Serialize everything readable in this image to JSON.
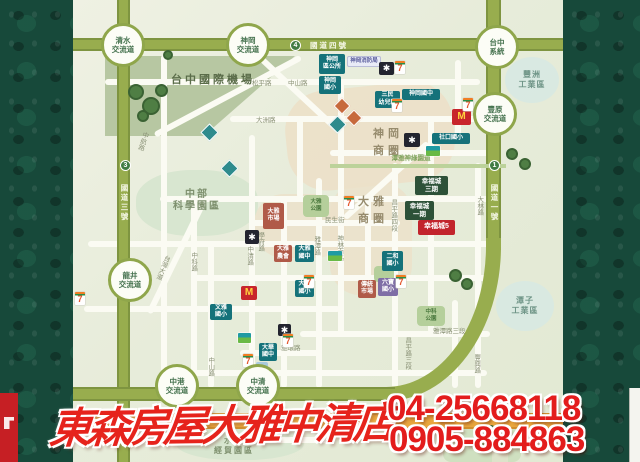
{
  "banner": {
    "store_name": "東森房屋大雅中清店",
    "phone_1": "04-25668118",
    "phone_2": "0905-884863"
  },
  "colors": {
    "accent_red": "#e3231d",
    "highway_olive": "#98ad4e",
    "orange_road": "#e8a63e",
    "school_teal": "#15727a",
    "project_green": "#2d5138",
    "featured_red": "#c2242c",
    "border_green": "#17493a"
  },
  "map": {
    "items": [
      {
        "n": "airport-zone",
        "c": "patch-sage",
        "x": 105,
        "y": 56,
        "w": 190,
        "h": 80
      },
      {
        "n": "science-park-zone",
        "c": "patch-mint",
        "x": 136,
        "y": 170,
        "w": 122,
        "h": 66
      },
      {
        "n": "shengang-commercial-zone",
        "c": "patch-beige",
        "x": 286,
        "y": 86,
        "w": 168,
        "h": 100,
        "rot": -6
      },
      {
        "n": "daya-commercial-zone",
        "c": "patch-beige2",
        "x": 330,
        "y": 183,
        "w": 82,
        "h": 112
      },
      {
        "n": "daya-commercial-zone",
        "c": "patch-beige2",
        "x": 254,
        "y": 194,
        "w": 92,
        "h": 64
      },
      {
        "n": "shuinan-zone",
        "c": "patch-mint",
        "x": 176,
        "y": 424,
        "w": 128,
        "h": 36
      },
      {
        "n": "stadium-zone",
        "c": "patch-green",
        "x": 443,
        "y": 418,
        "w": 78,
        "h": 44
      },
      {
        "n": "tree",
        "c": "tree",
        "x": 128,
        "y": 84,
        "w": 16,
        "h": 16
      },
      {
        "n": "tree",
        "c": "tree",
        "x": 142,
        "y": 97,
        "w": 18,
        "h": 18
      },
      {
        "n": "tree",
        "c": "tree",
        "x": 155,
        "y": 84,
        "w": 13,
        "h": 13
      },
      {
        "n": "tree",
        "c": "tree",
        "x": 137,
        "y": 110,
        "w": 12,
        "h": 12
      },
      {
        "n": "tree",
        "c": "tree",
        "x": 163,
        "y": 50,
        "w": 10,
        "h": 10
      },
      {
        "n": "tree",
        "c": "tree",
        "x": 231,
        "y": 51,
        "w": 10,
        "h": 10
      },
      {
        "n": "tree",
        "c": "tree",
        "x": 506,
        "y": 148,
        "w": 12,
        "h": 12
      },
      {
        "n": "tree",
        "c": "tree",
        "x": 519,
        "y": 158,
        "w": 12,
        "h": 12
      },
      {
        "n": "tree",
        "c": "tree",
        "x": 449,
        "y": 269,
        "w": 13,
        "h": 13
      },
      {
        "n": "tree",
        "c": "tree",
        "x": 461,
        "y": 278,
        "w": 12,
        "h": 12
      },
      {
        "n": "tree",
        "c": "tree",
        "x": 484,
        "y": 425,
        "w": 13,
        "h": 13
      },
      {
        "n": "tree",
        "c": "tree",
        "x": 497,
        "y": 436,
        "w": 12,
        "h": 12
      },
      {
        "n": "interchange-qingshui",
        "c": "ic",
        "x": 101,
        "y": 23,
        "t": "清水\n交流道"
      },
      {
        "n": "interchange-shengang",
        "c": "ic",
        "x": 226,
        "y": 23,
        "t": "神岡\n交流道"
      },
      {
        "n": "interchange-taichung-system",
        "c": "ic",
        "x": 475,
        "y": 25,
        "t": "台中\n系統"
      },
      {
        "n": "interchange-fengyuan",
        "c": "ic",
        "x": 473,
        "y": 92,
        "t": "豐原\n交流道"
      },
      {
        "n": "interchange-longjing",
        "c": "ic",
        "x": 108,
        "y": 258,
        "t": "龍井\n交流道"
      },
      {
        "n": "interchange-zhonggang",
        "c": "ic",
        "x": 155,
        "y": 364,
        "t": "中港\n交流道"
      },
      {
        "n": "interchange-zhongqing",
        "c": "ic",
        "x": 236,
        "y": 364,
        "t": "中清\n交流道"
      },
      {
        "n": "freeway4-shield",
        "c": "shield",
        "x": 290,
        "y": 40,
        "t": "4"
      },
      {
        "n": "freeway3-shield",
        "c": "shield",
        "x": 120,
        "y": 160,
        "t": "3"
      },
      {
        "n": "freeway1-shield",
        "c": "shield",
        "x": 489,
        "y": 160,
        "t": "1"
      },
      {
        "n": "freeway4-label",
        "c": "hlab",
        "x": 304,
        "y": 41,
        "w": 50,
        "t": "國道四號"
      },
      {
        "n": "freeway3-label",
        "c": "hlab-v",
        "x": 119,
        "y": 174,
        "w": 11,
        "h": 58,
        "t": "國道三號"
      },
      {
        "n": "freeway1-label",
        "c": "hlab-v",
        "x": 489,
        "y": 174,
        "w": 11,
        "h": 58,
        "t": "國道一號"
      },
      {
        "n": "area-label-airport",
        "c": "area-dark",
        "x": 157,
        "y": 74,
        "w": 112,
        "t": "台中國際機場"
      },
      {
        "n": "area-label-science-park",
        "c": "area",
        "x": 154,
        "y": 189,
        "w": 86,
        "t": "中部\n科學園區"
      },
      {
        "n": "area-label-shengang-shops",
        "c": "area-tan",
        "x": 360,
        "y": 126,
        "w": 56,
        "t": "神岡\n商圈"
      },
      {
        "n": "area-label-daya-shops",
        "c": "area-tan",
        "x": 346,
        "y": 194,
        "w": 54,
        "t": "大雅\n商圈"
      },
      {
        "n": "area-label-shuinan",
        "c": "area",
        "x": 192,
        "y": 436,
        "w": 84,
        "t": "水楠\n經貿園區",
        "fs": 8
      },
      {
        "n": "zone-fengzhou-industrial",
        "c": "zone",
        "x": 505,
        "y": 57,
        "w": 54,
        "h": 46,
        "t": "豐洲\n工業區"
      },
      {
        "n": "zone-tanzi-industrial",
        "c": "zone",
        "x": 496,
        "y": 281,
        "w": 58,
        "h": 50,
        "t": "潭子\n工業區"
      },
      {
        "n": "label-ballfield",
        "c": "green-lab",
        "x": 466,
        "y": 441,
        "w": 30,
        "t": "球場"
      },
      {
        "n": "label-bikeway",
        "c": "green-lab",
        "x": 378,
        "y": 155,
        "w": 66,
        "t": "潭雅神綠園道"
      },
      {
        "n": "road-label-songping",
        "c": "rlab",
        "x": 252,
        "y": 80,
        "t": "松平路"
      },
      {
        "n": "road-label-zhongshan-n",
        "c": "rlab",
        "x": 288,
        "y": 80,
        "t": "中山路"
      },
      {
        "n": "road-label-dazhou",
        "c": "rlab",
        "x": 256,
        "y": 117,
        "t": "大洲路"
      },
      {
        "n": "road-label-taiwan-blvd",
        "c": "rlab-v",
        "x": 158,
        "y": 246,
        "h": 42,
        "t": "台灣大道",
        "rot": 22
      },
      {
        "n": "road-label-zhongke",
        "c": "rlab-v",
        "x": 189,
        "y": 246,
        "h": 32,
        "t": "中科路"
      },
      {
        "n": "road-label-zhongshan-s",
        "c": "rlab-v",
        "x": 206,
        "y": 352,
        "h": 30,
        "t": "中山路"
      },
      {
        "n": "road-label-zhongqing",
        "c": "rlab-v",
        "x": 245,
        "y": 240,
        "h": 32,
        "t": "中清路"
      },
      {
        "n": "road-label-xuefu",
        "c": "rlab-v",
        "x": 256,
        "y": 227,
        "h": 30,
        "t": "學府路"
      },
      {
        "n": "road-label-yatan",
        "c": "rlab-v",
        "x": 312,
        "y": 230,
        "h": 32,
        "t": "雅潭路"
      },
      {
        "n": "road-label-shenlin-s",
        "c": "rlab-v",
        "x": 335,
        "y": 228,
        "h": 40,
        "t": "神林南路"
      },
      {
        "n": "road-label-changping-4",
        "c": "rlab-v",
        "x": 389,
        "y": 192,
        "h": 46,
        "t": "昌平路四段"
      },
      {
        "n": "road-label-changping-3",
        "c": "rlab-v",
        "x": 403,
        "y": 330,
        "h": 46,
        "t": "昌平路三段"
      },
      {
        "n": "road-label-yahuan",
        "c": "rlab",
        "x": 281,
        "y": 345,
        "t": "雅環路"
      },
      {
        "n": "road-label-yatan-3",
        "c": "rlab",
        "x": 433,
        "y": 328,
        "t": "雅潭路三段"
      },
      {
        "n": "road-label-dalin",
        "c": "rlab-v",
        "x": 475,
        "y": 190,
        "h": 32,
        "t": "大林路"
      },
      {
        "n": "road-label-fengxing",
        "c": "rlab-v",
        "x": 472,
        "y": 348,
        "h": 32,
        "t": "豐興路"
      },
      {
        "n": "road-label-minsheng",
        "c": "rlab",
        "x": 325,
        "y": 217,
        "t": "民生街"
      },
      {
        "n": "road-label-zhonghang",
        "c": "rlab-v",
        "x": 138,
        "y": 126,
        "h": 30,
        "t": "中航路",
        "rot": 18
      },
      {
        "n": "road-label-route10",
        "c": "rlab-white",
        "x": 296,
        "y": 412,
        "t": "台10線 中清路"
      },
      {
        "n": "poi-shengang-office",
        "c": "teal",
        "x": 319,
        "y": 54,
        "w": 26,
        "h": 20,
        "t": "神岡\n區公所"
      },
      {
        "n": "poi-shengang-elementary",
        "c": "teal",
        "x": 319,
        "y": 76,
        "w": 22,
        "h": 18,
        "t": "神岡\n國小"
      },
      {
        "n": "poi-fire-department",
        "c": "lav",
        "x": 347,
        "y": 56,
        "w": 34,
        "h": 11,
        "t": "神岡消防局"
      },
      {
        "n": "poi-sanmin-kindergarten",
        "c": "teal",
        "x": 375,
        "y": 91,
        "w": 25,
        "h": 17,
        "t": "三民\n幼兒園"
      },
      {
        "n": "poi-shengang-junior-high",
        "c": "teal",
        "x": 402,
        "y": 89,
        "w": 38,
        "h": 11,
        "t": "神岡國中"
      },
      {
        "n": "poi-shekou-elementary",
        "c": "teal",
        "x": 432,
        "y": 133,
        "w": 38,
        "h": 11,
        "t": "社口國小"
      },
      {
        "n": "poi-daya-market",
        "c": "terra",
        "x": 263,
        "y": 203,
        "w": 21,
        "h": 26,
        "t": "大雅\n市場"
      },
      {
        "n": "poi-farmers-association",
        "c": "terra",
        "x": 274,
        "y": 245,
        "w": 18,
        "h": 17,
        "t": "大雅\n農會"
      },
      {
        "n": "poi-daya-junior-high",
        "c": "teal",
        "x": 295,
        "y": 245,
        "w": 19,
        "h": 17,
        "t": "大雅\n國中"
      },
      {
        "n": "poi-daya-elementary",
        "c": "teal",
        "x": 295,
        "y": 280,
        "w": 19,
        "h": 17,
        "t": "大雅\n國小"
      },
      {
        "n": "poi-wenya-elementary",
        "c": "teal",
        "x": 210,
        "y": 304,
        "w": 22,
        "h": 16,
        "t": "文雅\n國小"
      },
      {
        "n": "poi-erhe-elementary",
        "c": "teal",
        "x": 382,
        "y": 251,
        "w": 21,
        "h": 20,
        "t": "二和\n國小"
      },
      {
        "n": "poi-traditional-market",
        "c": "terra",
        "x": 358,
        "y": 280,
        "w": 18,
        "h": 18,
        "t": "傳統\n市場"
      },
      {
        "n": "poi-liubao-elementary",
        "c": "purple",
        "x": 378,
        "y": 278,
        "w": 20,
        "h": 18,
        "t": "六寶\n國小"
      },
      {
        "n": "poi-dahua-junior-high",
        "c": "teal",
        "x": 259,
        "y": 343,
        "w": 18,
        "h": 18,
        "t": "大華\n國中"
      },
      {
        "n": "poi-xingfucheng-3",
        "c": "green",
        "x": 415,
        "y": 176,
        "w": 33,
        "h": 19,
        "t": "幸福城\n三期"
      },
      {
        "n": "poi-xingfucheng-1",
        "c": "green",
        "x": 405,
        "y": 201,
        "w": 29,
        "h": 19,
        "t": "幸福城\n一期"
      },
      {
        "n": "poi-xingfucheng-5",
        "c": "red",
        "x": 418,
        "y": 220,
        "w": 37,
        "h": 15,
        "t": "幸福城5"
      },
      {
        "n": "park-label-daya",
        "c": "park",
        "x": 303,
        "y": 195,
        "w": 26,
        "h": 22,
        "t": "大雅\n公園"
      },
      {
        "n": "park-label-zhongke",
        "c": "park",
        "x": 417,
        "y": 306,
        "w": 28,
        "h": 20,
        "t": "中科\n公園"
      },
      {
        "n": "park-patch",
        "c": "park",
        "x": 374,
        "y": 266,
        "w": 20,
        "h": 16
      },
      {
        "n": "pxmart-icon",
        "c": "px",
        "x": 379,
        "y": 62,
        "w": 15,
        "h": 13,
        "t": "✱"
      },
      {
        "n": "pxmart-icon",
        "c": "px",
        "x": 404,
        "y": 133,
        "w": 16,
        "h": 14,
        "t": "✱"
      },
      {
        "n": "pxmart-icon",
        "c": "px",
        "x": 245,
        "y": 230,
        "w": 14,
        "h": 14,
        "t": "✱"
      },
      {
        "n": "pxmart-icon",
        "c": "px",
        "x": 278,
        "y": 324,
        "w": 13,
        "h": 12,
        "t": "✱"
      },
      {
        "n": "mcdonalds-icon",
        "c": "mcd",
        "x": 452,
        "y": 109,
        "w": 19,
        "h": 16,
        "t": "M"
      },
      {
        "n": "mcdonalds-icon",
        "c": "mcd",
        "x": 241,
        "y": 286,
        "w": 16,
        "h": 14,
        "t": "M"
      },
      {
        "n": "seven-eleven-icon",
        "c": "seven",
        "x": 395,
        "y": 61,
        "w": 10,
        "h": 13,
        "t": "7"
      },
      {
        "n": "seven-eleven-icon",
        "c": "seven",
        "x": 392,
        "y": 99,
        "w": 10,
        "h": 13,
        "t": "7"
      },
      {
        "n": "seven-eleven-icon",
        "c": "seven",
        "x": 463,
        "y": 98,
        "w": 10,
        "h": 13,
        "t": "7"
      },
      {
        "n": "seven-eleven-icon",
        "c": "seven",
        "x": 344,
        "y": 196,
        "w": 10,
        "h": 13,
        "t": "7"
      },
      {
        "n": "seven-eleven-icon",
        "c": "seven",
        "x": 396,
        "y": 275,
        "w": 10,
        "h": 13,
        "t": "7"
      },
      {
        "n": "seven-eleven-icon",
        "c": "seven",
        "x": 304,
        "y": 275,
        "w": 10,
        "h": 13,
        "t": "7"
      },
      {
        "n": "seven-eleven-icon",
        "c": "seven",
        "x": 243,
        "y": 354,
        "w": 10,
        "h": 13,
        "t": "7"
      },
      {
        "n": "seven-eleven-icon",
        "c": "seven",
        "x": 283,
        "y": 334,
        "w": 10,
        "h": 13,
        "t": "7"
      },
      {
        "n": "seven-eleven-icon",
        "c": "seven",
        "x": 75,
        "y": 292,
        "w": 10,
        "h": 13,
        "t": "7"
      },
      {
        "n": "familymart-icon",
        "c": "fm",
        "x": 426,
        "y": 146,
        "w": 14,
        "h": 10
      },
      {
        "n": "familymart-icon",
        "c": "fm",
        "x": 238,
        "y": 333,
        "w": 13,
        "h": 10
      },
      {
        "n": "familymart-icon",
        "c": "fm",
        "x": 328,
        "y": 251,
        "w": 14,
        "h": 10
      },
      {
        "n": "temple-icon",
        "c": "dia-t",
        "x": 203,
        "y": 126,
        "w": 13,
        "h": 13
      },
      {
        "n": "temple-icon",
        "c": "dia-t",
        "x": 223,
        "y": 162,
        "w": 13,
        "h": 13
      },
      {
        "n": "temple-icon",
        "c": "dia-t",
        "x": 331,
        "y": 118,
        "w": 13,
        "h": 13
      },
      {
        "n": "temple-icon",
        "c": "dia-o",
        "x": 336,
        "y": 100,
        "w": 12,
        "h": 12
      },
      {
        "n": "temple-icon",
        "c": "dia-o",
        "x": 348,
        "y": 112,
        "w": 12,
        "h": 12
      },
      {
        "n": "bus-stop-icon",
        "c": "bus",
        "x": 256,
        "y": 362,
        "w": 12,
        "h": 9
      }
    ]
  }
}
